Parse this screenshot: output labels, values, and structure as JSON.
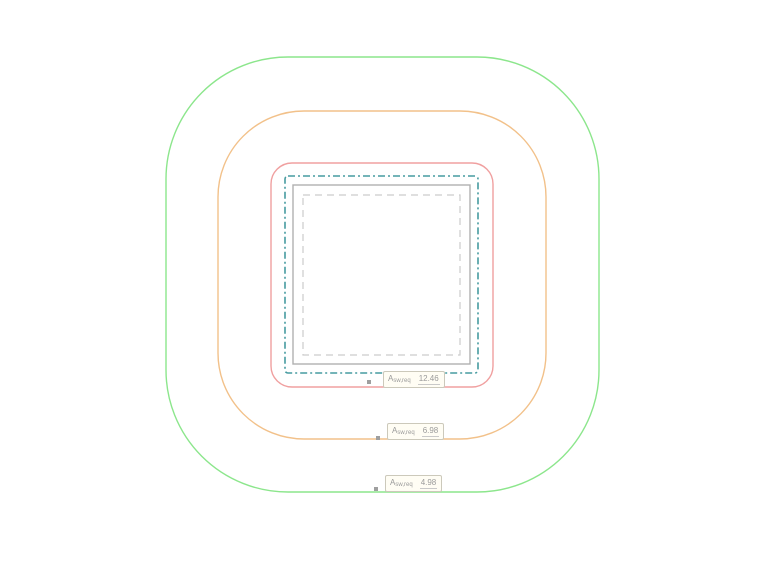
{
  "diagram": {
    "background": "#ffffff",
    "shapes": [
      {
        "id": "outer-perimeter-green",
        "type": "rounded-rect",
        "x": 166,
        "y": 57,
        "w": 433,
        "h": 435,
        "rx": 122,
        "stroke": "#8ce68c",
        "dash": "",
        "stroke_width": 1.4
      },
      {
        "id": "middle-perimeter-orange",
        "type": "rounded-rect",
        "x": 218,
        "y": 111,
        "w": 328,
        "h": 328,
        "rx": 86,
        "stroke": "#f2c18a",
        "dash": "",
        "stroke_width": 1.4
      },
      {
        "id": "inner-perimeter-red",
        "type": "rounded-rect",
        "x": 271,
        "y": 163,
        "w": 222,
        "h": 224,
        "rx": 21,
        "stroke": "#f0a0a0",
        "dash": "",
        "stroke_width": 1.4
      },
      {
        "id": "control-perimeter-teal",
        "type": "rounded-rect",
        "x": 285,
        "y": 176,
        "w": 193,
        "h": 197,
        "rx": 3,
        "stroke": "#469ba0",
        "dash": "7 3 2 3",
        "stroke_width": 1.6
      },
      {
        "id": "column-outline-gray",
        "type": "rounded-rect",
        "x": 293,
        "y": 185,
        "w": 177,
        "h": 179,
        "rx": 0,
        "stroke": "#b0b0b0",
        "dash": "",
        "stroke_width": 1.4
      },
      {
        "id": "inner-outline-dashed",
        "type": "rounded-rect",
        "x": 303,
        "y": 195,
        "w": 157,
        "h": 160,
        "rx": 0,
        "stroke": "#cccccc",
        "dash": "7 5",
        "stroke_width": 1.2
      }
    ],
    "labels": [
      {
        "symbol": "A",
        "subscript": "sw,req",
        "value": "12.46",
        "box": {
          "left": 383,
          "top": 371
        },
        "marker": {
          "left": 367,
          "top": 380
        }
      },
      {
        "symbol": "A",
        "subscript": "sw,req",
        "value": "6.98",
        "box": {
          "left": 387,
          "top": 423
        },
        "marker": {
          "left": 376,
          "top": 436
        }
      },
      {
        "symbol": "A",
        "subscript": "sw,req",
        "value": "4.98",
        "box": {
          "left": 385,
          "top": 475
        },
        "marker": {
          "left": 374,
          "top": 487
        }
      }
    ],
    "label_style": {
      "bg": "#fffdf4",
      "border": "#ccc9bb",
      "text": "#9a9a9a",
      "underline": "#c9c9c9",
      "marker": "#9f9f9f"
    }
  }
}
